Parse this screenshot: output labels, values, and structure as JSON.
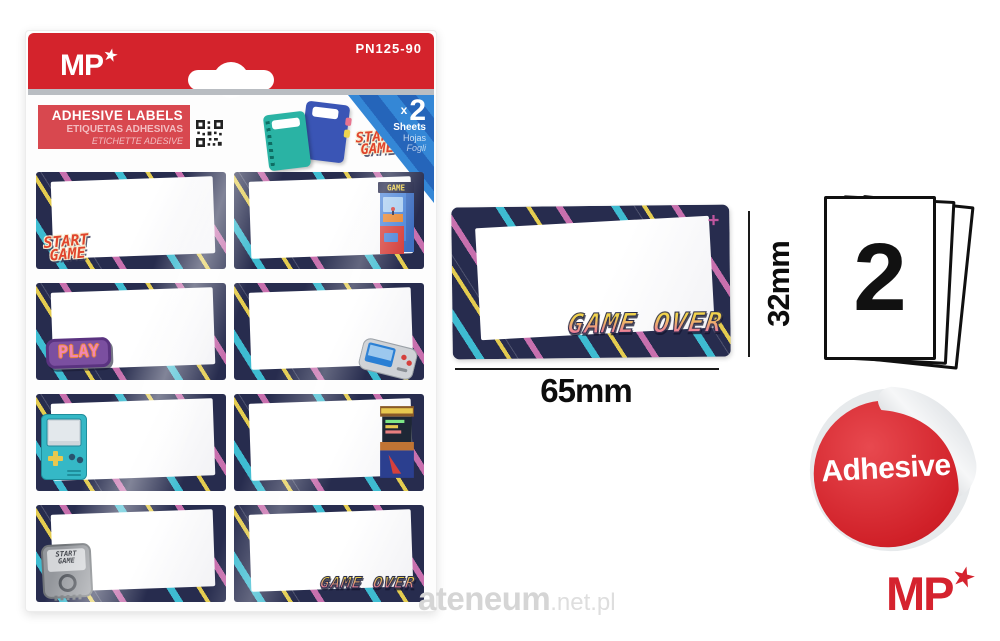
{
  "colors": {
    "brand_red": "#d4232c",
    "title_box_red": "#d8484f",
    "label_navy": "#272c4e",
    "stripe_teal": "#3fc4d8",
    "stripe_pink": "#d977b8",
    "stripe_yellow": "#eed54f",
    "corner_blue": "#2e7cc8",
    "play_purple": "#7b4fa0",
    "gameover_gradient_top": "#f2d44d",
    "gameover_gradient_bottom": "#ec6fa8"
  },
  "package": {
    "brand": "MP",
    "brand_star": "★",
    "product_code": "PN125-90",
    "title_box": {
      "en": "ADHESIVE LABELS",
      "es": "ETIQUETAS ADHESIVAS",
      "it": "ETICHETTE ADESIVE"
    },
    "sheets_corner": {
      "times": "x",
      "count": "2",
      "en": "Sheets",
      "es": "Hojas",
      "it": "Fogli"
    },
    "promo_logo": {
      "line1": "START",
      "line2": "GAME"
    },
    "labels": {
      "start_game": {
        "line1": "START",
        "line2": "GAME"
      },
      "arcade_marquee": "GAME",
      "play": "PLAY",
      "game_over": "GAME OVER",
      "console": {
        "line1": "START",
        "line2": "GAME"
      }
    }
  },
  "detail_label": {
    "logo": "GAME OVER",
    "plus": "+",
    "width": "65mm",
    "height": "32mm"
  },
  "sheets_badge": {
    "count": "2"
  },
  "adhesive_badge": {
    "label": "Adhesive"
  },
  "footer_brand": {
    "text": "MP",
    "star": "★"
  },
  "watermark": {
    "name": "ateneum",
    "domain": ".net.pl"
  }
}
